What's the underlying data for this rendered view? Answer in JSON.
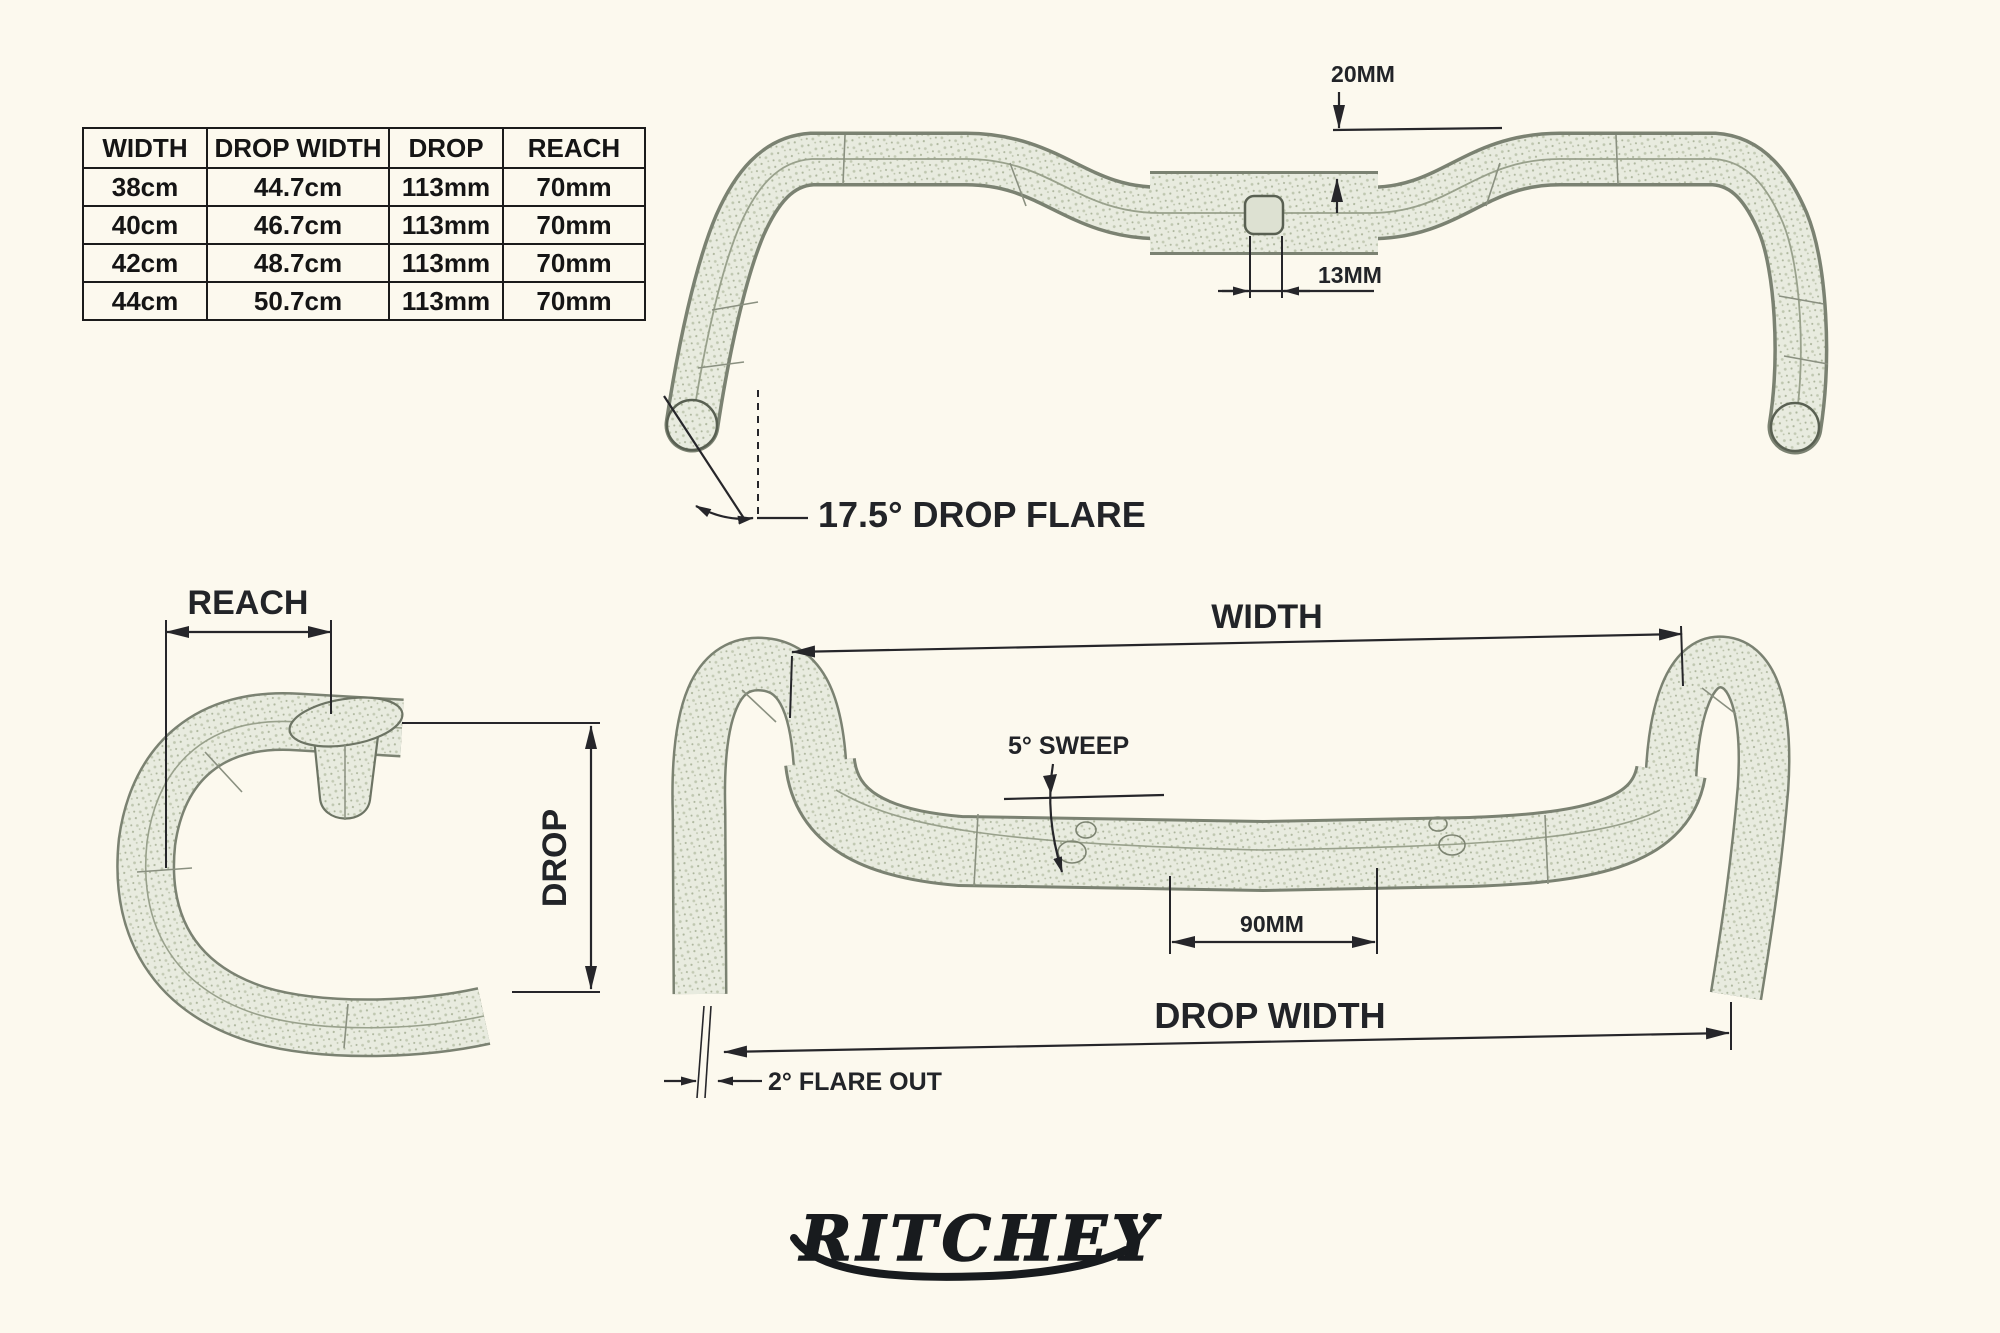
{
  "spec_table": {
    "headers": [
      "WIDTH",
      "DROP WIDTH",
      "DROP",
      "REACH"
    ],
    "rows": [
      [
        "38cm",
        "44.7cm",
        "113mm",
        "70mm"
      ],
      [
        "40cm",
        "46.7cm",
        "113mm",
        "70mm"
      ],
      [
        "42cm",
        "48.7cm",
        "113mm",
        "70mm"
      ],
      [
        "44cm",
        "50.7cm",
        "113mm",
        "70mm"
      ]
    ]
  },
  "annotations": {
    "top_view": {
      "rise": "20MM",
      "center_offset": "13MM",
      "drop_flare": "17.5° DROP FLARE"
    },
    "side_view": {
      "reach": "REACH",
      "drop": "DROP"
    },
    "front_view": {
      "width": "WIDTH",
      "sweep": "5° SWEEP",
      "center_width": "90MM",
      "drop_width": "DROP WIDTH",
      "flare_out": "2° FLARE OUT"
    }
  },
  "logo": {
    "brand": "RITCHEY"
  },
  "colors": {
    "paper": "#fcf9ee",
    "ink": "#26262a",
    "sketch_line": "#6d7464",
    "sketch_fill": "#e8ebdf",
    "sketch_dot": "#bfc7b0"
  }
}
